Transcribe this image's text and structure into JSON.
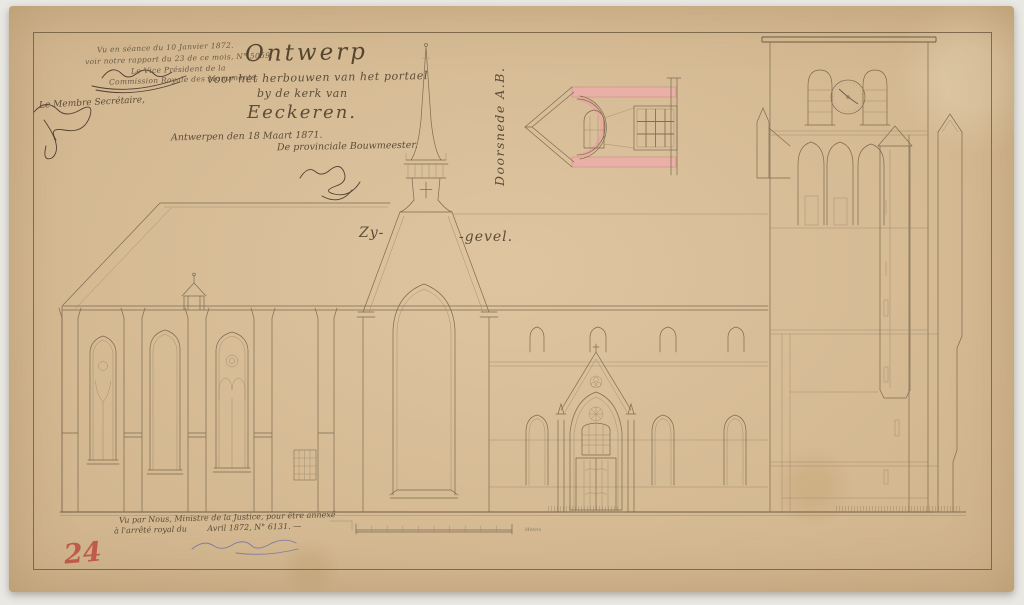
{
  "colors": {
    "paper": "#d8bd96",
    "drawing_line": "#7d6b50",
    "ink": "#5c4c38",
    "section_wash_pink": "#eaafa6",
    "stamp_red": "#bf4b3e",
    "minister_ink_purple": "#837aa3"
  },
  "approval_note": {
    "line1": "Vu en séance du 10 Janvier 1872.",
    "line2": "voir notre rapport du 23 de ce mois, N° 5059.",
    "line3": "Le Vice Président de la",
    "line4": "Commission Royale des Monuments,",
    "secretary": "Le Membre Secrétaire,"
  },
  "title_block": {
    "line1": "Ontwerp",
    "line2": "voor het herbouwen van het portael",
    "line3": "by de kerk van",
    "line4": "Eeckeren.",
    "date_line": "Antwerpen den 18 Maart 1871.",
    "author_line": "De provinciale Bouwmeester."
  },
  "labels": {
    "elevation_left": "Zy-",
    "elevation_right": "-gevel.",
    "section": "Doorsnede A.B."
  },
  "minister_note": {
    "line1": "Vu par Nous, Ministre de la Justice, pour être annexé",
    "line2": "à l'arrêté royal du        Avril 1872, N° 6131. —"
  },
  "inventory_number": "24",
  "scale_bar": {
    "divisions": 10,
    "unit_label": "Meters"
  }
}
